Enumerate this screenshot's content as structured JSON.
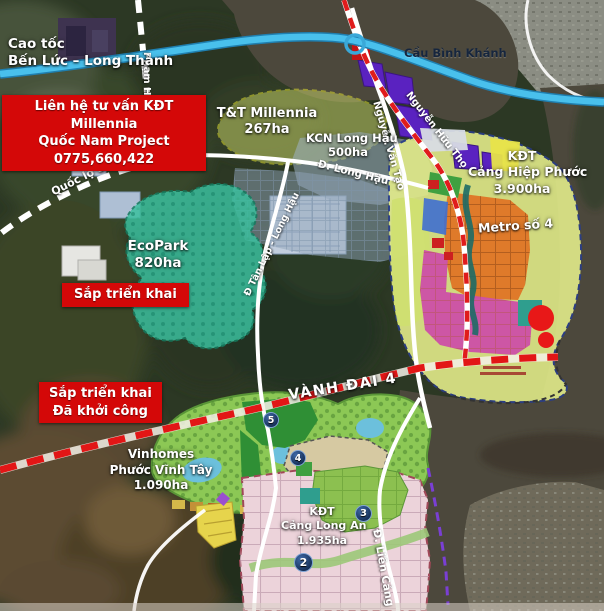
{
  "map": {
    "expressway": {
      "line1": "Cao tốc",
      "line2": "Bến Lức – Long Thành"
    },
    "contact_banner": {
      "line1": "Liên hệ tư vấn KĐT Millennia",
      "line2": "Quốc Nam Project 0775,660,422"
    },
    "bridge": "Cầu Bình Khánh",
    "metro_line": "Metro số 4",
    "ring_road": "VÀNH ĐAI 4",
    "status_upcoming": "Sắp triển khai",
    "status_started": {
      "line1": "Sắp triển khai",
      "line2": "Đã khởi công"
    },
    "projects": {
      "tt_millennia": {
        "name": "T&T Millennia",
        "area": "267ha"
      },
      "kcn_long_hau": {
        "name": "KCN Long Hậu",
        "area": "500ha"
      },
      "kdt_cang_hiep_phuoc": {
        "prefix": "KĐT",
        "name": "Cảng Hiệp Phước",
        "area": "3.900ha"
      },
      "ecopark": {
        "name": "EcoPark",
        "area": "820ha"
      },
      "vinhomes": {
        "name": "Vinhomes",
        "name2": "Phước Vĩnh Tây",
        "area": "1.090ha"
      },
      "kdt_cang_long_an": {
        "prefix": "KĐT",
        "name": "Cảng Long An",
        "area": "1.935ha"
      }
    },
    "roads": {
      "quoc_lo_50b": "Quốc lộ 50B",
      "quoc_lo_50": "Quốc lộ 50",
      "pham_hung": "Phạm Hùng",
      "d_long_hau": "Đ. Long Hậu",
      "d_tan_lap_long_hau": "Đ Tân Lập - Long Hậu",
      "nguyen_van_tao": "Nguyễn Văn Tạo",
      "nguyen_huu_tho": "Nguyễn Hữu Thọ",
      "d_lien_cang": "Đ. Liên Cảng"
    },
    "markers": {
      "m2": "2",
      "m3": "3",
      "m4": "4",
      "m5": "5"
    },
    "colors": {
      "banner_red": "#d40808",
      "ring_road_red": "#e21616",
      "expressway_blue": "#49c0ec",
      "ecopark_teal": "#3bbf9e",
      "vinhomes_green": "#8cc855",
      "hiep_phuoc_yellow": "#e3ec8a",
      "zone_purple": "#5a22c0",
      "zone_orange": "#df7a2a",
      "zone_pink": "#cc4fa8"
    }
  }
}
